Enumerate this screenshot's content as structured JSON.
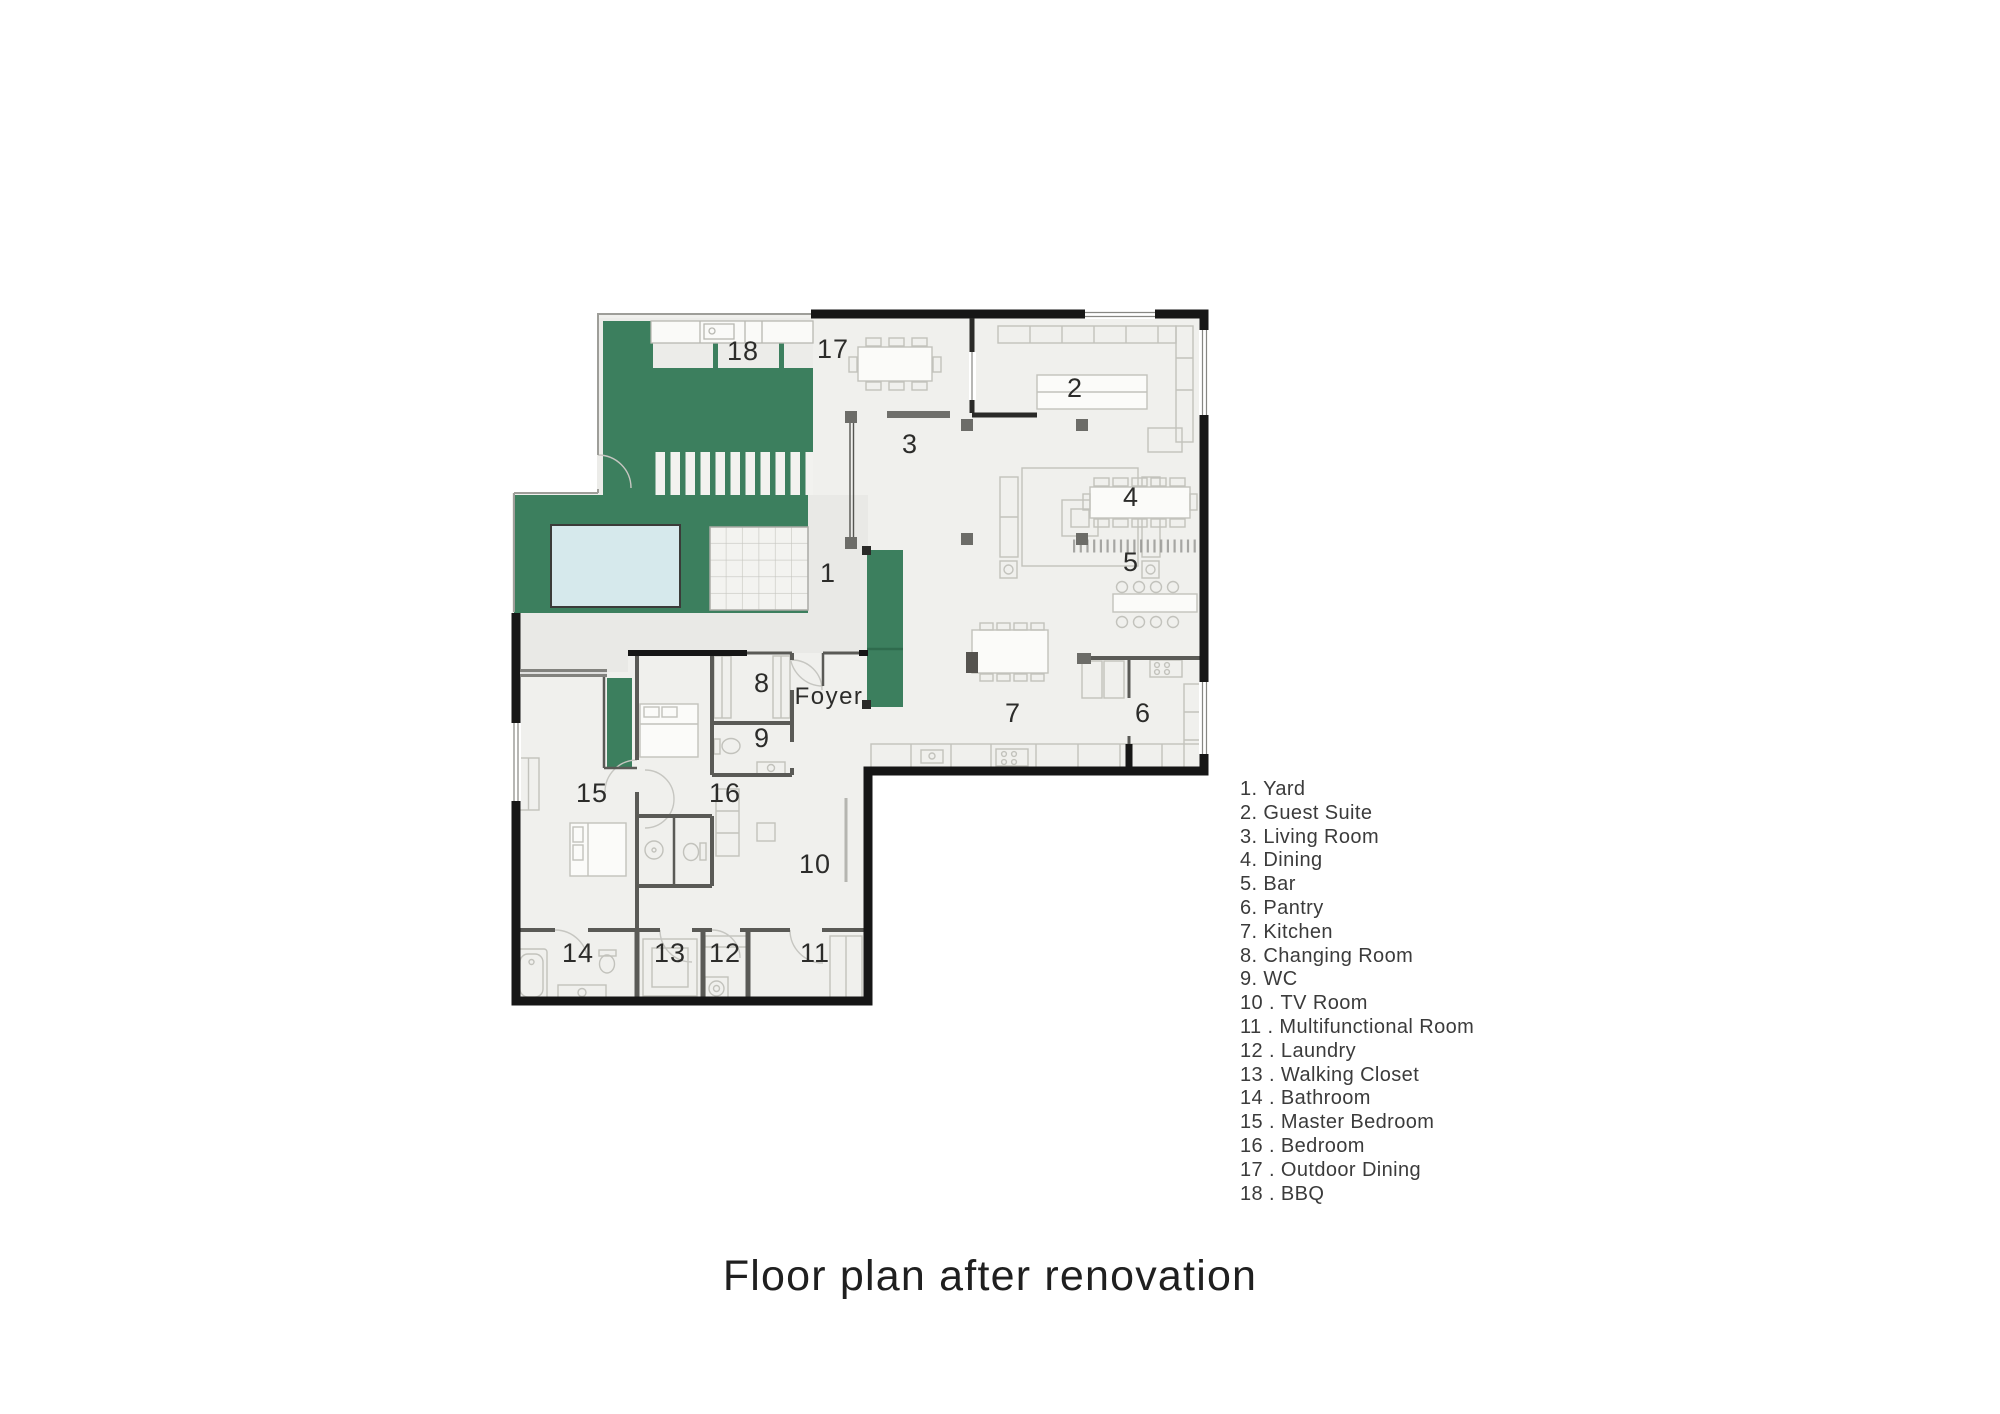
{
  "title": "Floor plan after renovation",
  "legend": {
    "items": [
      "1. Yard",
      "2. Guest Suite",
      "3. Living Room",
      "4. Dining",
      "5. Bar",
      "6. Pantry",
      "7. Kitchen",
      "8. Changing Room",
      "9. WC",
      "10 . TV Room",
      "11 . Multifunctional Room",
      "12 . Laundry",
      "13 . Walking Closet",
      "14 . Bathroom",
      "15 . Master Bedroom",
      "16 . Bedroom",
      "17 . Outdoor Dining",
      "18 . BBQ"
    ]
  },
  "plan": {
    "foyer": "Foyer",
    "rooms": {
      "r1": {
        "label": "1",
        "name": "Yard"
      },
      "r2": {
        "label": "2",
        "name": "Guest Suite"
      },
      "r3": {
        "label": "3",
        "name": "Living Room"
      },
      "r4": {
        "label": "4",
        "name": "Dining"
      },
      "r5": {
        "label": "5",
        "name": "Bar"
      },
      "r6": {
        "label": "6",
        "name": "Pantry"
      },
      "r7": {
        "label": "7",
        "name": "Kitchen"
      },
      "r8": {
        "label": "8",
        "name": "Changing Room"
      },
      "r9": {
        "label": "9",
        "name": "WC"
      },
      "r10": {
        "label": "10",
        "name": "TV Room"
      },
      "r11": {
        "label": "11",
        "name": "Multifunctional Room"
      },
      "r12": {
        "label": "12",
        "name": "Laundry"
      },
      "r13": {
        "label": "13",
        "name": "Walking Closet"
      },
      "r14": {
        "label": "14",
        "name": "Bathroom"
      },
      "r15": {
        "label": "15",
        "name": "Master Bedroom"
      },
      "r16": {
        "label": "16",
        "name": "Bedroom"
      },
      "r17": {
        "label": "17",
        "name": "Outdoor Dining"
      },
      "r18": {
        "label": "18",
        "name": "BBQ"
      }
    }
  },
  "colors": {
    "green": "#3C7F5E",
    "pool_water": "#D6E9EC",
    "wall": "#161616",
    "floor": "#F0F0ED"
  }
}
